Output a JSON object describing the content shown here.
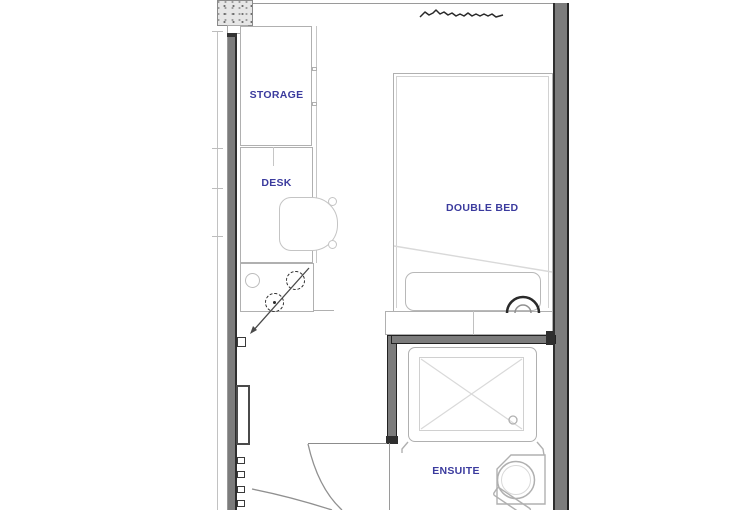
{
  "plan": {
    "rooms": {
      "storage_label": "STORAGE",
      "desk_label": "DESK",
      "bed_label": "DOUBLE BED",
      "ensuite_label": "ENSUITE"
    },
    "colors": {
      "background": "#ffffff",
      "label_text": "#3b3b9e",
      "wall_fill": "#7c7c7c",
      "wall_edge": "#2e2e2e",
      "furniture_line": "#b0b0b0",
      "symbol_line": "#2a2a2a"
    }
  }
}
